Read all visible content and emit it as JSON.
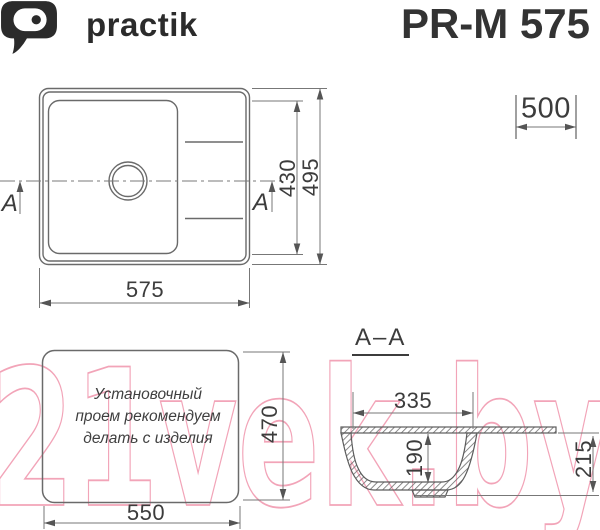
{
  "header": {
    "brand": "practik",
    "model": "PR-M 575"
  },
  "top_view": {
    "dim_width": "575",
    "dim_bowl_depth": "430",
    "dim_overall_depth": "495",
    "dim_cabinet_width": "500",
    "section_marker_left": "A",
    "section_marker_right": "A"
  },
  "install_view": {
    "note_line1": "Установочный",
    "note_line2": "проем рекомендуем",
    "note_line3": "делать с изделия",
    "dim_width": "550",
    "dim_depth": "470"
  },
  "section_view": {
    "title": "A–A",
    "dim_bowl_top_width": "335",
    "dim_bowl_depth": "190",
    "dim_total_depth": "215"
  },
  "watermark": {
    "text": "21vek.by",
    "color": "#f2a4b8"
  },
  "colors": {
    "line": "#6a6a6a",
    "text": "#3c3c3c",
    "brand": "#2b2b2b"
  }
}
